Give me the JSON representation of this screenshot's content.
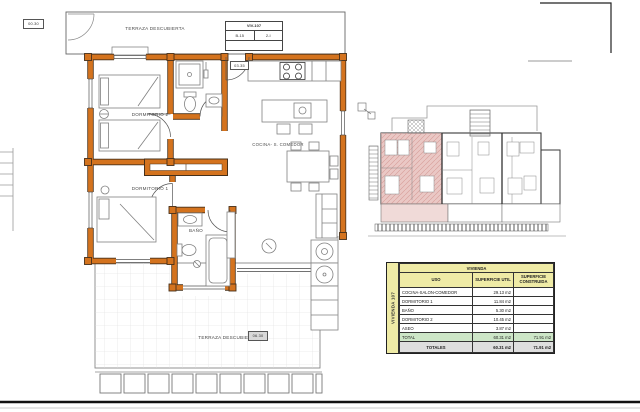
{
  "colors": {
    "wall_fill": "#D4731E",
    "wall_edge": "#47301A",
    "highlight_pink": "#EAC8C5",
    "table_yellow": "#EFEBA6",
    "table_green": "#CDE6C7",
    "table_gray": "#DEDEDE"
  },
  "plan": {
    "terrace_top": "TERRAZA DESCUBIERTA",
    "terrace_bottom": "TERRAZA DESCUBIERTA",
    "bedroom2": "DORMITORIO 2",
    "bedroom1": "DORMITORIO 1",
    "bath": "BAÑO",
    "kitchen": "COCINA- S. COMEDOR",
    "unit_box": {
      "title": "VIV-107",
      "left": "B-15",
      "right": "2-I"
    },
    "level_tags": {
      "top_left": "00.30",
      "entrance": "03.35",
      "terrace": "06.30"
    }
  },
  "table": {
    "title": "VIVIENDA",
    "side_label": "VIVIENDA 107",
    "columns": [
      "USO",
      "SUPERFICIE UTIL",
      "SUPERFICIE CONSTRUIDA"
    ],
    "rows": [
      {
        "uso": "COCINA-SALON-COMEDOR",
        "util": "29.13 m2",
        "construida": ""
      },
      {
        "uso": "DORMITORIO 1",
        "util": "11.84 m2",
        "construida": ""
      },
      {
        "uso": "BAÑO",
        "util": "5.30 m2",
        "construida": ""
      },
      {
        "uso": "DORMITORIO 2",
        "util": "10.45 m2",
        "construida": ""
      },
      {
        "uso": "ASEO",
        "util": "3.87 m2",
        "construida": ""
      },
      {
        "uso": "TOTAL",
        "util": "60.31 m2",
        "construida": "71.91 m2"
      }
    ],
    "totals_label": "TOTALES",
    "totals_util": "60.31 m2",
    "totals_construida": "71.91 m2"
  }
}
